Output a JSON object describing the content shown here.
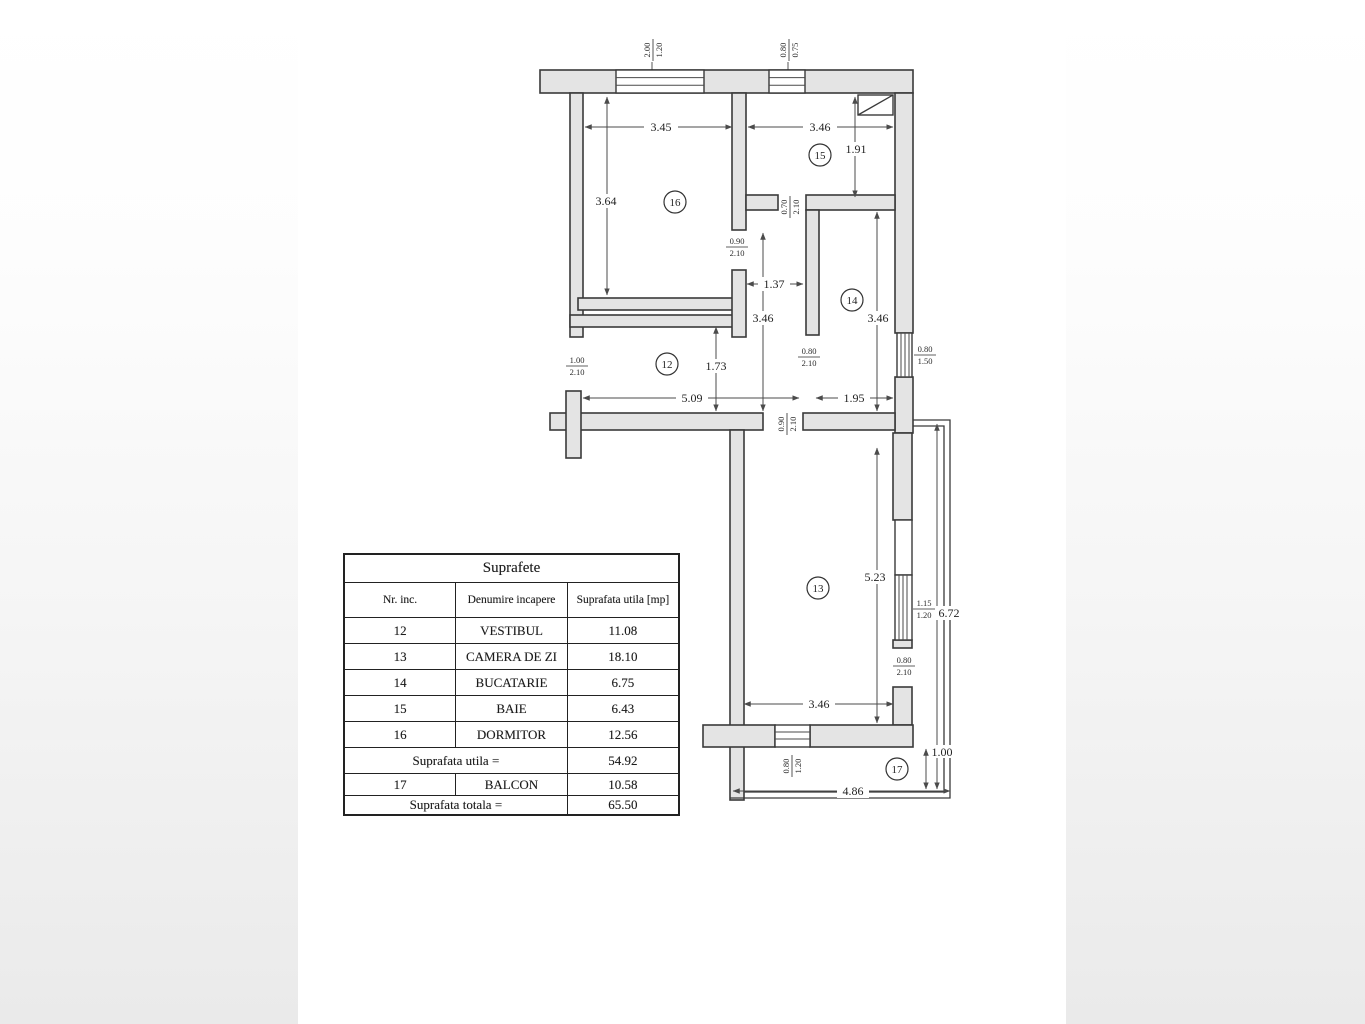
{
  "plan": {
    "room_labels": {
      "r12": "12",
      "r13": "13",
      "r14": "14",
      "r15": "15",
      "r16": "16",
      "r17": "17"
    },
    "dims": {
      "w16": "3.45",
      "w15": "3.46",
      "h15": "1.91",
      "h16": "3.64",
      "hall_w": "1.37",
      "hall_h": "3.46",
      "h14": "3.46",
      "h12": "1.73",
      "w12": "5.09",
      "w14": "1.95",
      "h13": "5.23",
      "w13": "3.46",
      "balcony_len": "6.72",
      "balcony_w": "4.86",
      "balcony_d": "1.00"
    },
    "openings": {
      "win_16": {
        "w": "2.00",
        "h": "1.20"
      },
      "win_15": {
        "w": "0.80",
        "h": "0.75"
      },
      "door_16": {
        "w": "0.90",
        "h": "2.10"
      },
      "door_15": {
        "w": "0.70",
        "h": "2.10"
      },
      "door_entry": {
        "w": "1.00",
        "h": "2.10"
      },
      "door_14": {
        "w": "0.80",
        "h": "2.10"
      },
      "win_14": {
        "w": "0.80",
        "h": "1.50"
      },
      "door_13": {
        "w": "0.90",
        "h": "2.10"
      },
      "win_13r": {
        "w": "1.15",
        "h": "1.20"
      },
      "door_balcony": {
        "w": "0.80",
        "h": "2.10"
      },
      "win_13b": {
        "w": "0.80",
        "h": "1.20"
      }
    }
  },
  "table": {
    "title": "Suprafete",
    "headers": [
      "Nr. inc.",
      "Denumire incapere",
      "Suprafata utila [mp]"
    ],
    "rows": [
      [
        "12",
        "VESTIBUL",
        "11.08"
      ],
      [
        "13",
        "CAMERA DE ZI",
        "18.10"
      ],
      [
        "14",
        "BUCATARIE",
        "6.75"
      ],
      [
        "15",
        "BAIE",
        "6.43"
      ],
      [
        "16",
        "DORMITOR",
        "12.56"
      ]
    ],
    "subtotal": {
      "label": "Suprafata utila =",
      "value": "54.92"
    },
    "balcony_row": [
      "17",
      "BALCON",
      "10.58"
    ],
    "total": {
      "label": "Suprafata totala =",
      "value": "65.50"
    }
  }
}
